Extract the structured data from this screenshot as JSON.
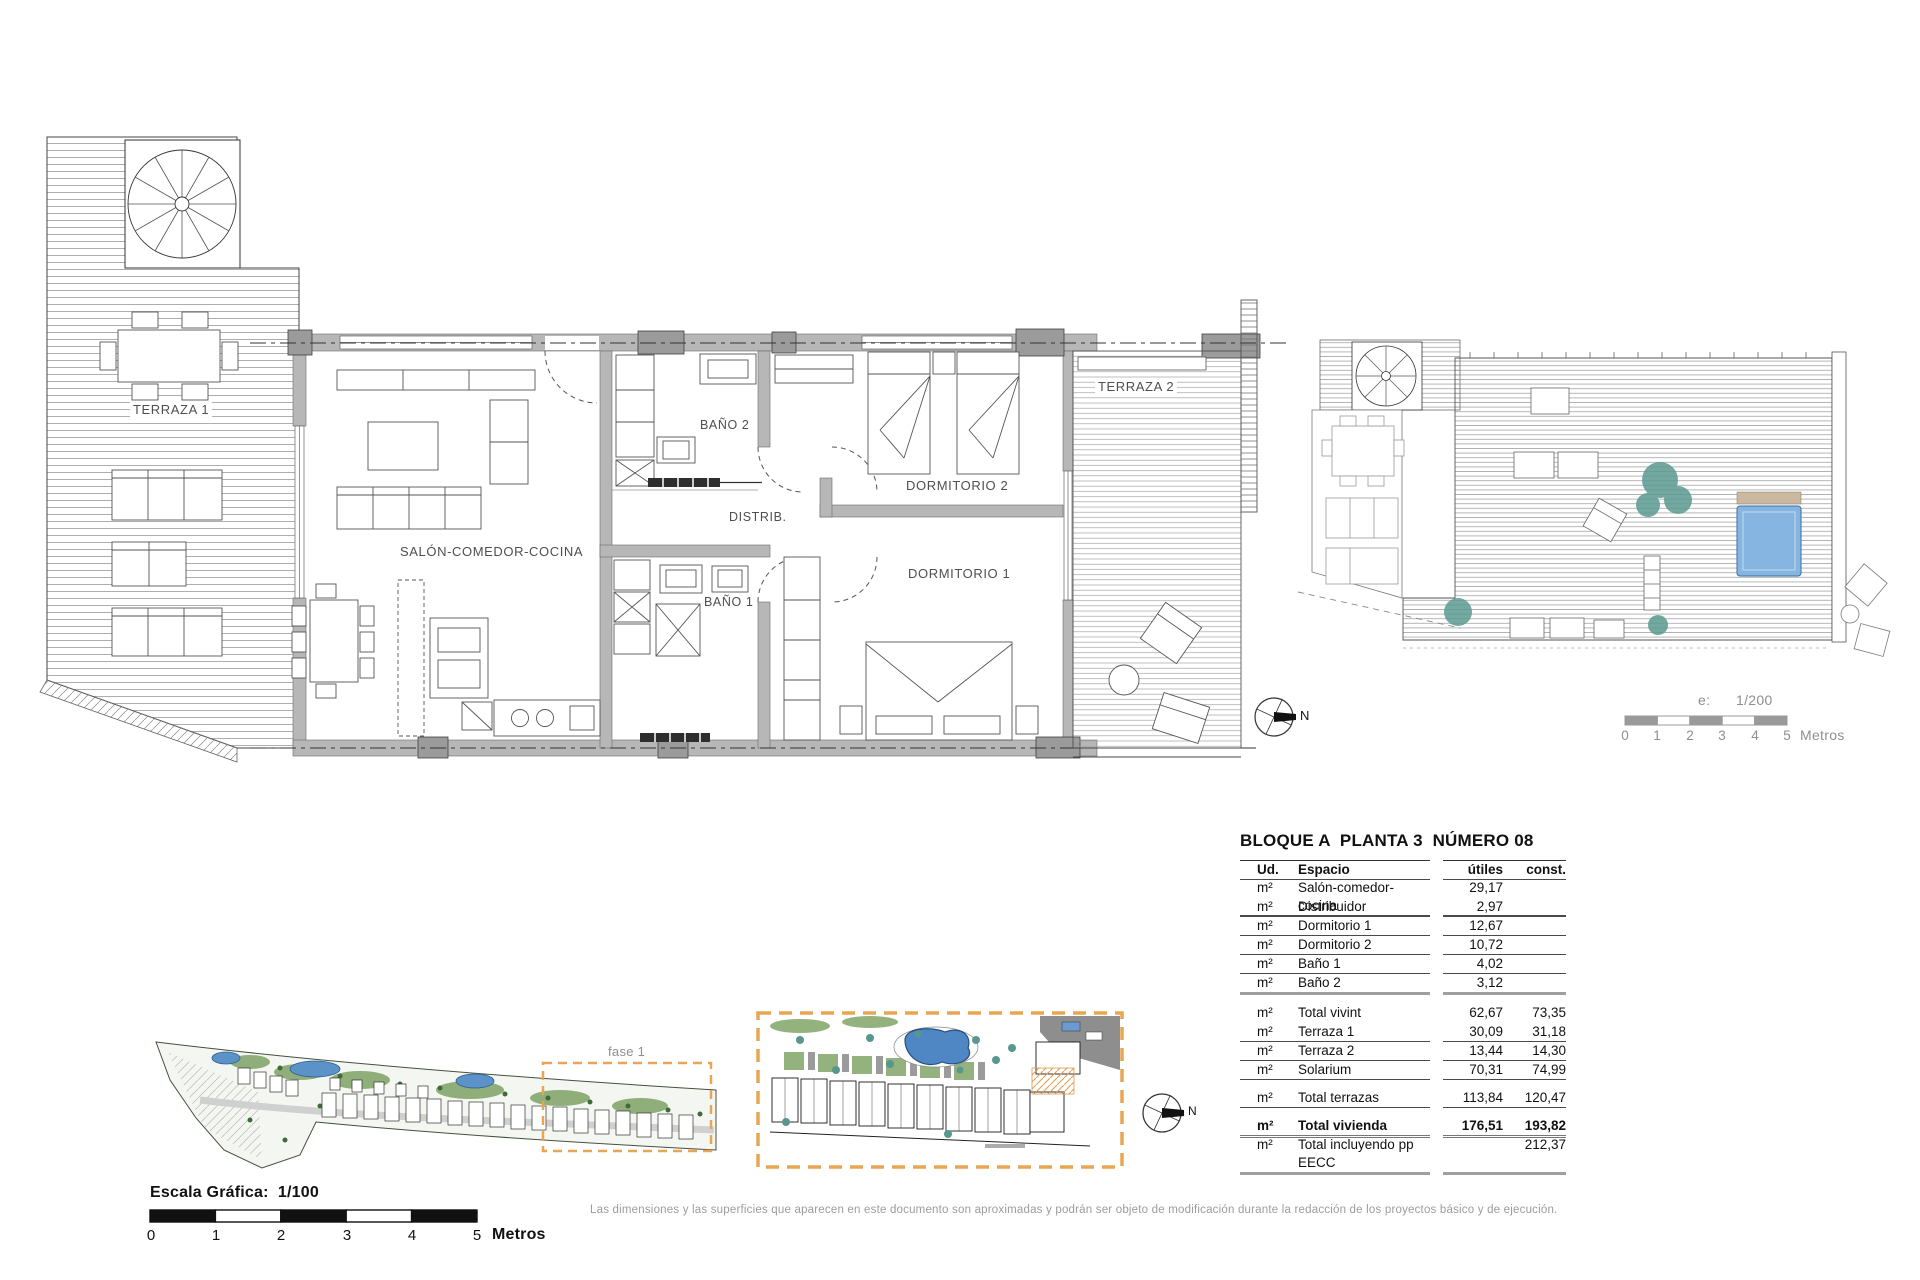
{
  "floor_plan": {
    "terraza1": "TERRAZA 1",
    "salon": "SALÓN-COMEDOR-COCINA",
    "bano2": "BAÑO 2",
    "distribuidor": "DISTRIB.",
    "dormitorio2": "DORMITORIO 2",
    "dormitorio1": "DORMITORIO 1",
    "bano1": "BAÑO 1",
    "terraza2": "TERRAZA 2",
    "north": "N"
  },
  "solarium_scale": {
    "prefix": "e:",
    "ratio": "1/200",
    "ticks": [
      "0",
      "1",
      "2",
      "3",
      "4",
      "5"
    ],
    "units": "Metros"
  },
  "site_plan": {
    "phase": "fase 1",
    "north": "N",
    "scale_title": "Escala Gráfica:  1/100",
    "ticks": [
      "0",
      "1",
      "2",
      "3",
      "4",
      "5"
    ],
    "units": "Metros"
  },
  "area_table": {
    "title": "BLOQUE A  PLANTA 3  NÚMERO 08",
    "columns": {
      "unit": "Ud.",
      "space": "Espacio",
      "utiles": "útiles",
      "const": "const."
    },
    "rows": [
      {
        "unit": "m²",
        "space": "Salón-comedor-cocina",
        "utiles": "29,17",
        "const": ""
      },
      {
        "unit": "m²",
        "space": "Distribuidor",
        "utiles": "2,97",
        "const": ""
      },
      {
        "unit": "m²",
        "space": "Dormitorio 1",
        "utiles": "12,67",
        "const": ""
      },
      {
        "unit": "m²",
        "space": "Dormitorio 2",
        "utiles": "10,72",
        "const": ""
      },
      {
        "unit": "m²",
        "space": "Baño 1",
        "utiles": "4,02",
        "const": ""
      },
      {
        "unit": "m²",
        "space": "Baño 2",
        "utiles": "3,12",
        "const": ""
      },
      {
        "unit": "m²",
        "space": "Total vivint",
        "utiles": "62,67",
        "const": "73,35"
      },
      {
        "unit": "m²",
        "space": "Terraza 1",
        "utiles": "30,09",
        "const": "31,18"
      },
      {
        "unit": "m²",
        "space": "Terraza 2",
        "utiles": "13,44",
        "const": "14,30"
      },
      {
        "unit": "m²",
        "space": "Solarium",
        "utiles": "70,31",
        "const": "74,99"
      },
      {
        "unit": "m²",
        "space": "Total terrazas",
        "utiles": "113,84",
        "const": "120,47"
      },
      {
        "unit": "m²",
        "space": "Total vivienda",
        "utiles": "176,51",
        "const": "193,82"
      },
      {
        "unit": "m²",
        "space": "Total incluyendo pp EECC",
        "utiles": "",
        "const": "212,37"
      }
    ]
  },
  "footer": {
    "disclaimer": "Las dimensiones y las superficies que aparecen en este documento son aproximadas y podrán ser objeto de modificación durante la redacción de los proyectos básico y de ejecución."
  }
}
